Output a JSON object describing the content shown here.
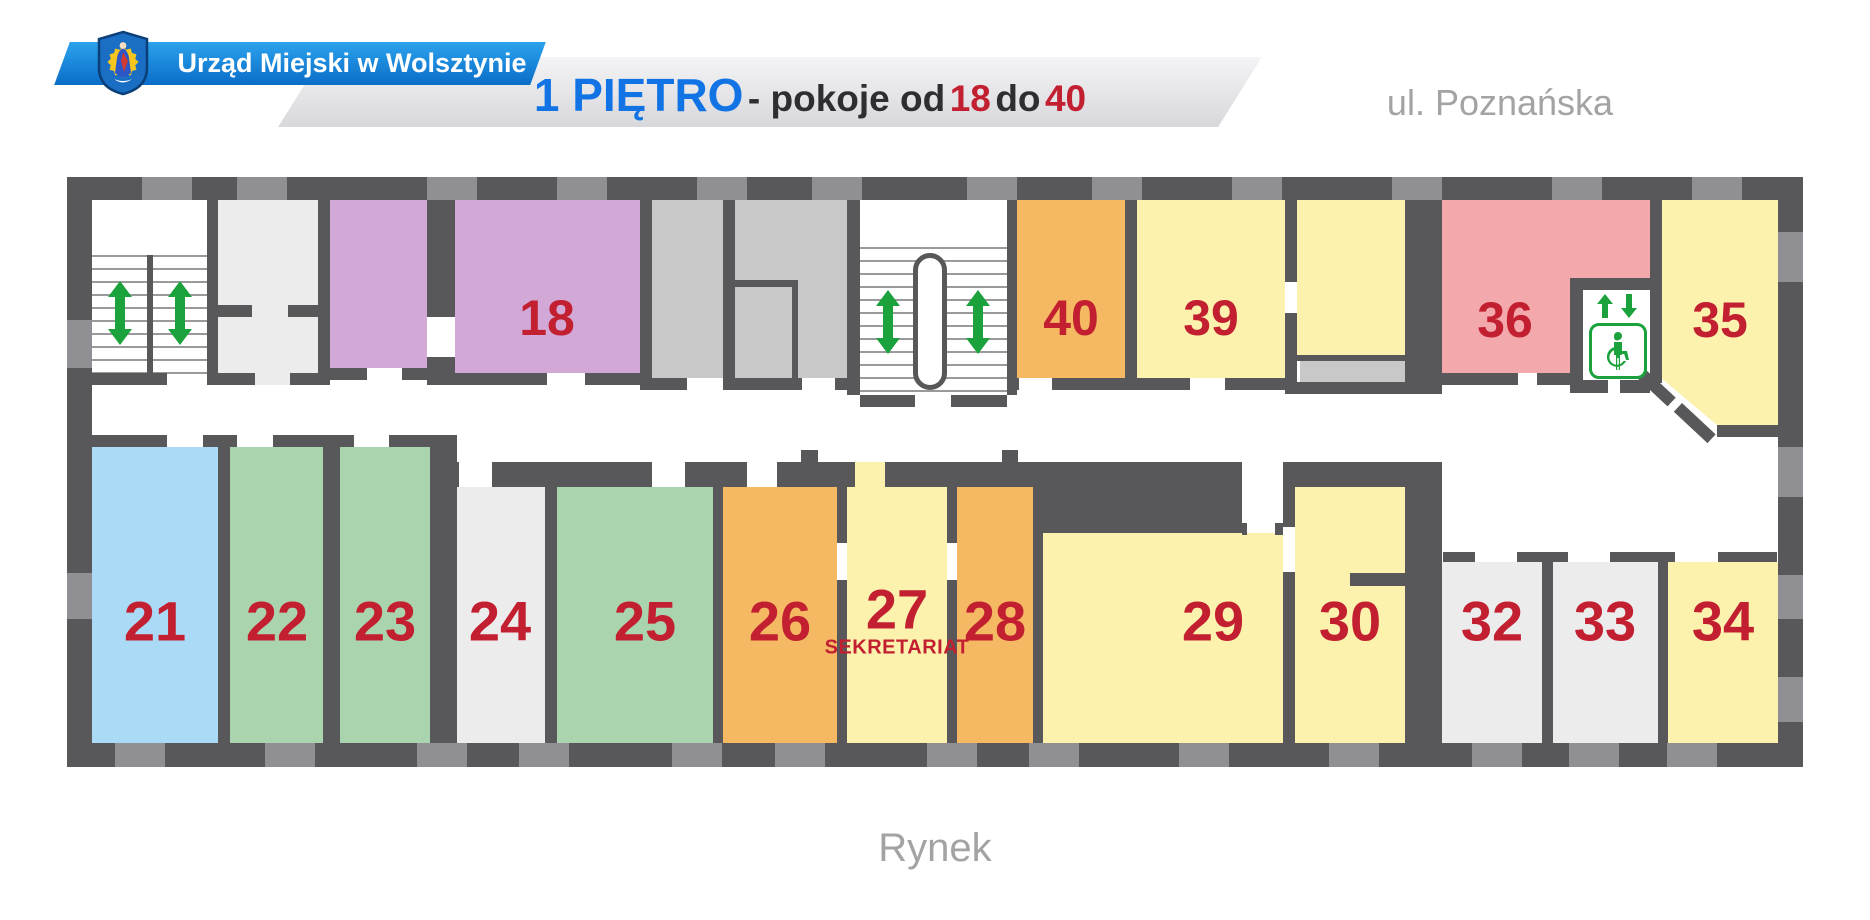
{
  "header": {
    "org_name": "Urząd Miejski w Wolsztynie",
    "floor_title": "1 PIĘTRO",
    "subtitle_prefix": "- pokoje od",
    "room_from": "18",
    "subtitle_conj": "do",
    "room_to": "40"
  },
  "streets": {
    "top": "ul. Poznańska",
    "bottom": "Rynek"
  },
  "rooms": {
    "r18": {
      "number": "18"
    },
    "r21": {
      "number": "21"
    },
    "r22": {
      "number": "22"
    },
    "r23": {
      "number": "23"
    },
    "r24": {
      "number": "24"
    },
    "r25": {
      "number": "25"
    },
    "r26": {
      "number": "26"
    },
    "r27": {
      "number": "27",
      "sublabel": "SEKRETARIAT"
    },
    "r28": {
      "number": "28"
    },
    "r29": {
      "number": "29"
    },
    "r30": {
      "number": "30"
    },
    "r32": {
      "number": "32"
    },
    "r33": {
      "number": "33"
    },
    "r34": {
      "number": "34"
    },
    "r35": {
      "number": "35"
    },
    "r36": {
      "number": "36"
    },
    "r39": {
      "number": "39"
    },
    "r40": {
      "number": "40"
    }
  },
  "icons": {
    "crest": "wolsztyn-coat-of-arms",
    "stairs": "up-down-arrow",
    "elevator_arrows": "up-down-arrow",
    "elevator_person": "person",
    "elevator_wheelchair": "wheelchair"
  },
  "colors": {
    "wall": "#58585a",
    "window": "#909094",
    "room_yellow": "#fcf2ad",
    "room_orange": "#f5b963",
    "room_green": "#aad4ad",
    "room_blue": "#aadaf5",
    "room_purple": "#d2a9d6",
    "room_pink": "#f3a8ab",
    "room_gray_light": "#ececec",
    "room_gray_mid": "#c8c8c8",
    "number_red": "#c22031",
    "icon_green": "#1ba23c",
    "banner_top": "#2ba2ec",
    "banner_bottom": "#0b6dc8",
    "title_blue": "#1274e4",
    "title_dark": "#2e2e30",
    "street_gray": "#a3a3a5",
    "ribbon_light": "#f4f4f6",
    "ribbon_dark": "#d8d8dc"
  }
}
